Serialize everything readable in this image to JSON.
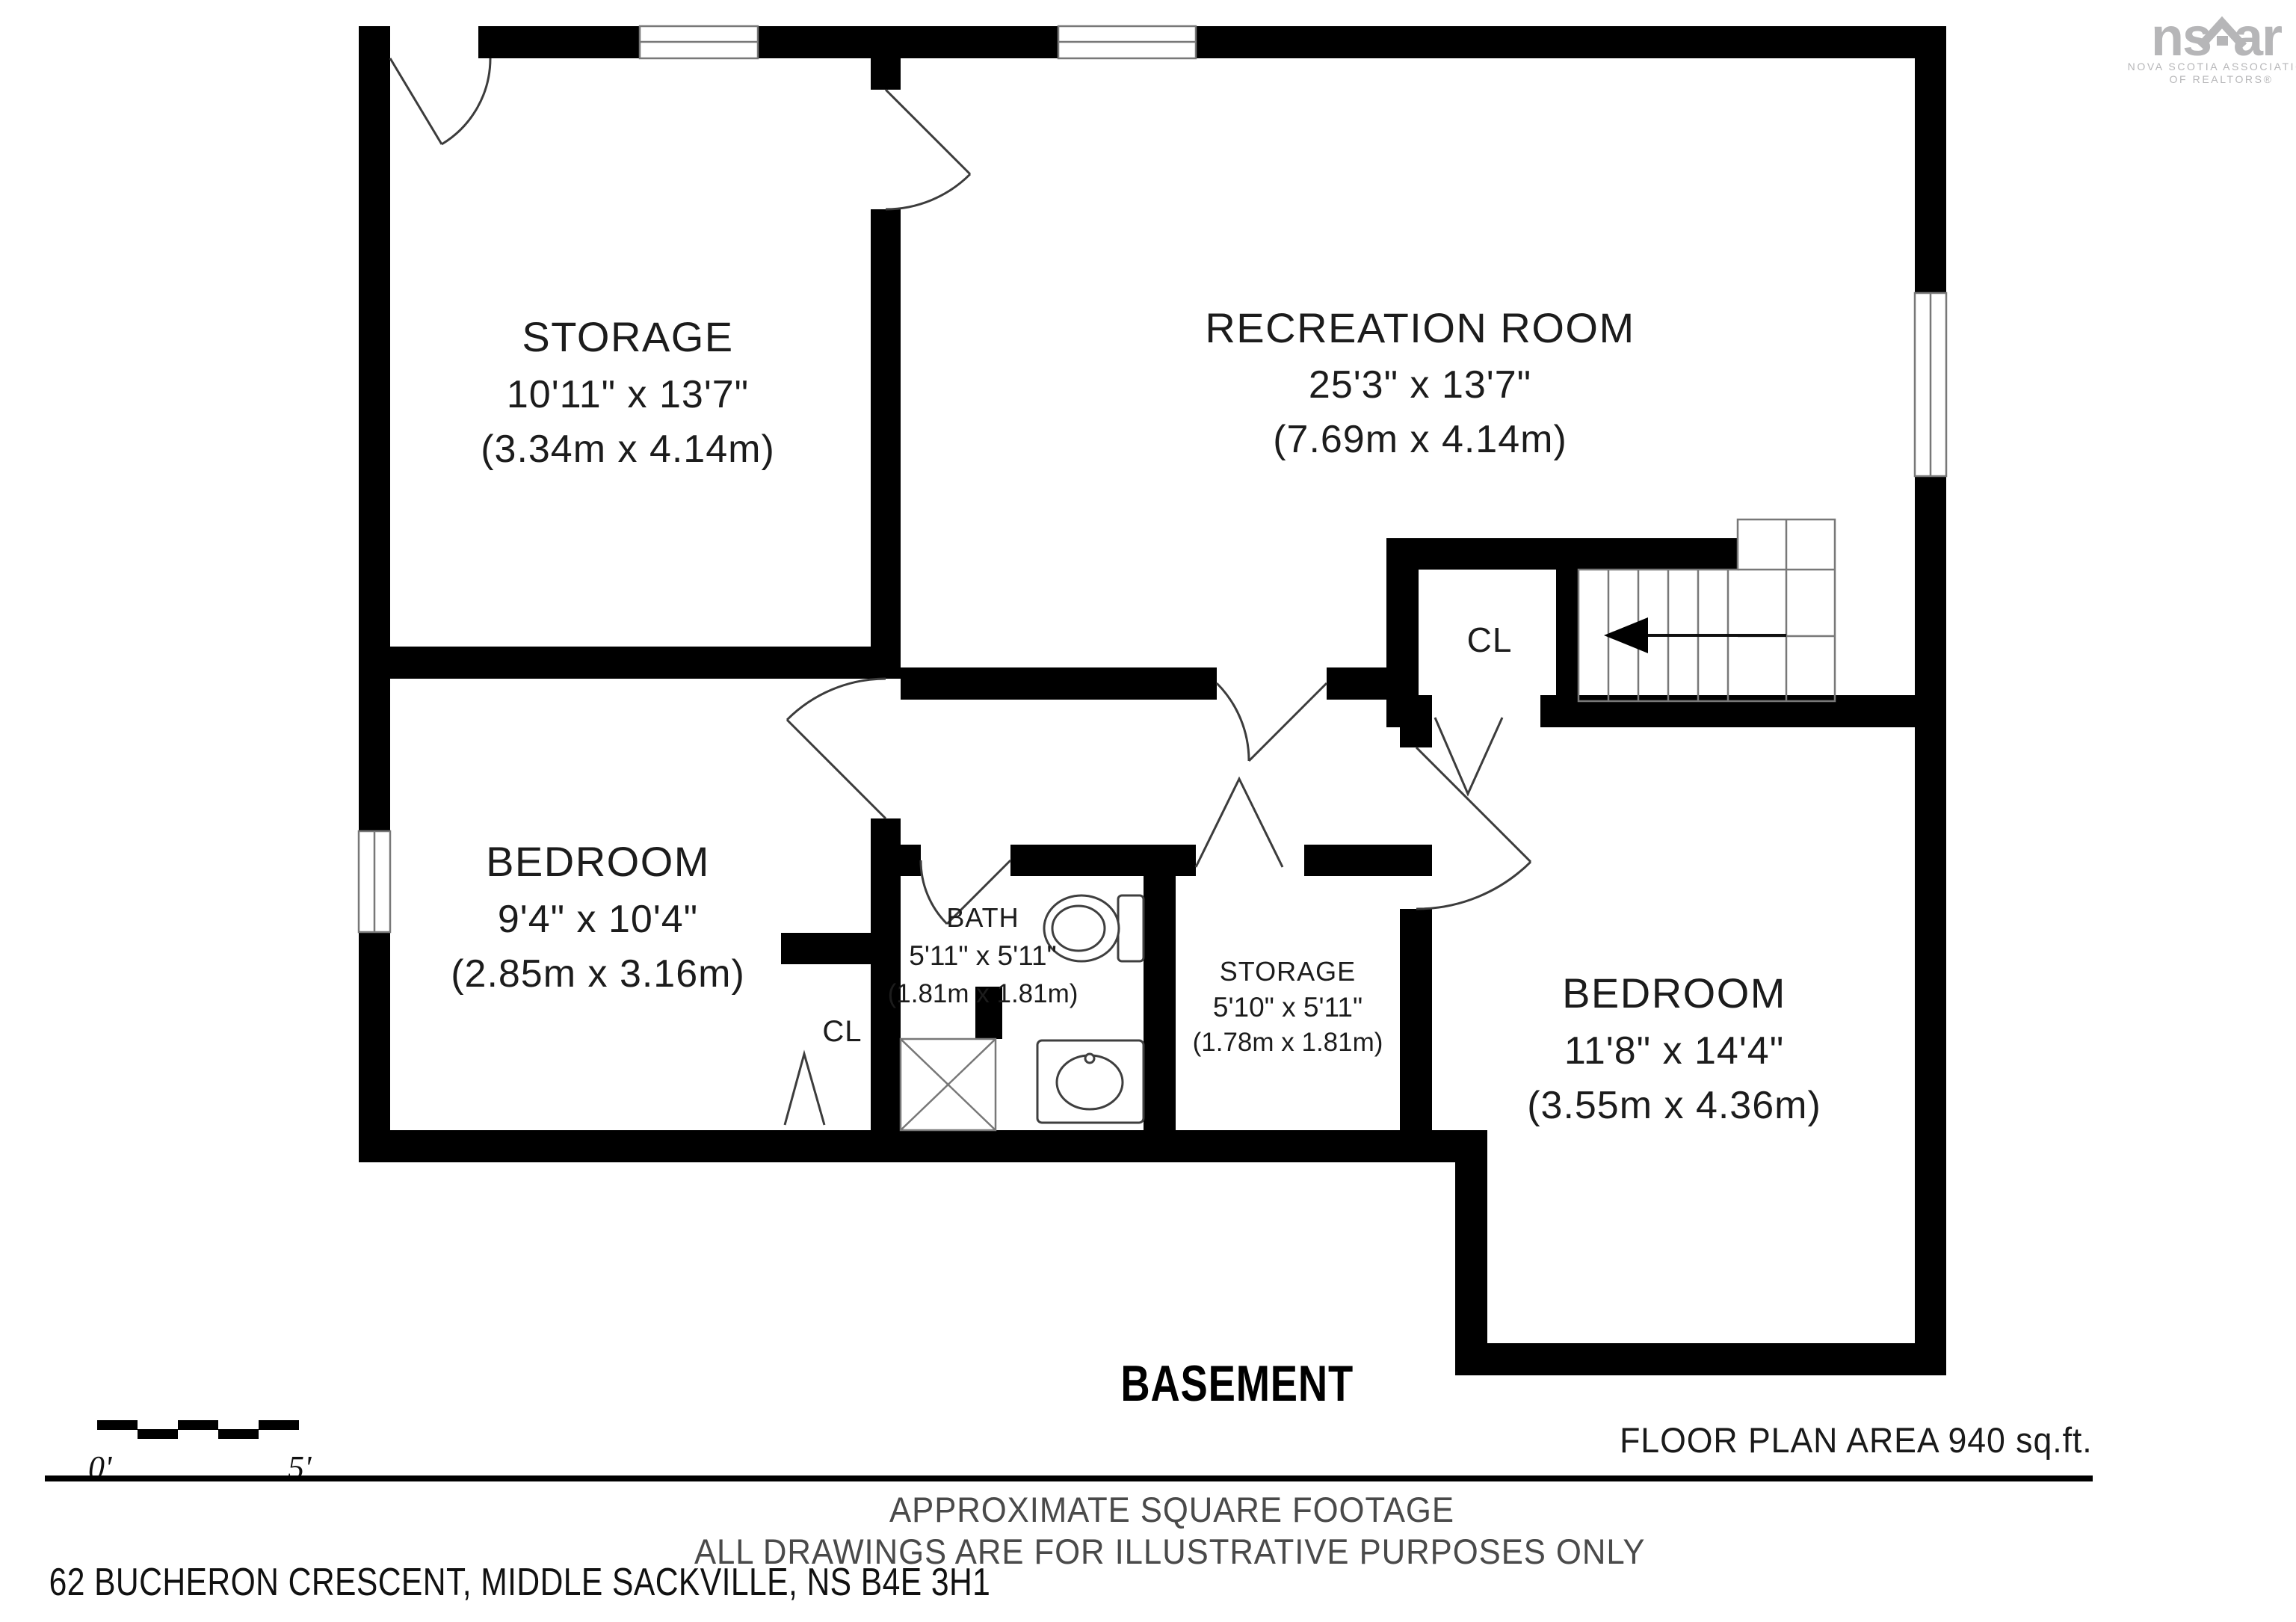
{
  "logo": {
    "mark_left": "ns",
    "mark_right": "ar",
    "line1": "NOVA SCOTIA ASSOCIATION",
    "line2": "OF REALTORS®"
  },
  "rooms": {
    "storage_large": {
      "name": "STORAGE",
      "imperial": "10'11\" x 13'7\"",
      "metric": "(3.34m x 4.14m)"
    },
    "recreation": {
      "name": "RECREATION ROOM",
      "imperial": "25'3\" x 13'7\"",
      "metric": "(7.69m x 4.14m)"
    },
    "bedroom_left": {
      "name": "BEDROOM",
      "imperial": "9'4\" x 10'4\"",
      "metric": "(2.85m x 3.16m)"
    },
    "bath": {
      "name": "BATH",
      "imperial": "5'11\" x 5'11\"",
      "metric": "(1.81m x 1.81m)"
    },
    "storage_small": {
      "name": "STORAGE",
      "imperial": "5'10\" x 5'11\"",
      "metric": "(1.78m x 1.81m)"
    },
    "bedroom_right": {
      "name": "BEDROOM",
      "imperial": "11'8\" x 14'4\"",
      "metric": "(3.55m x 4.36m)"
    },
    "closet_hall": {
      "name": "CL"
    },
    "closet_bedroom": {
      "name": "CL"
    }
  },
  "floor": {
    "title": "BASEMENT"
  },
  "scale_bar": {
    "start": "0'",
    "end": "5'"
  },
  "footer": {
    "area": "FLOOR PLAN AREA 940 sq.ft.",
    "note1": "APPROXIMATE SQUARE FOOTAGE",
    "note2": "ALL DRAWINGS ARE FOR ILLUSTRATIVE PURPOSES ONLY",
    "address": "62 BUCHERON CRESCENT, MIDDLE SACKVILLE, NS B4E 3H1"
  },
  "colors": {
    "wall": "#000000",
    "thin_line": "#787878",
    "door_line": "#3c3c3c",
    "text": "#1c1c1c",
    "note_text": "#4a4a4a",
    "logo": "#b6b6b8"
  }
}
